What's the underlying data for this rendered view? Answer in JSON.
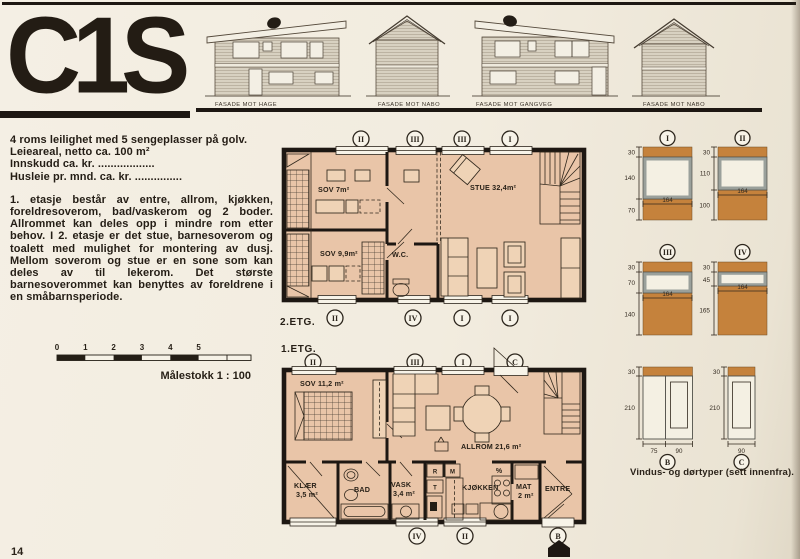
{
  "page": {
    "logo": "C1S",
    "page_number": "14"
  },
  "facades": {
    "labels": [
      "FASADE MOT HAGE",
      "FASADE MOT NABO",
      "FASADE MOT GANGVEG",
      "FASADE MOT NABO"
    ]
  },
  "intro": {
    "line1": "4 roms leilighet med 5 sengeplasser på golv.",
    "line2": "Leieareal, netto ca. 100 m²",
    "line3": "Innskudd ca. kr. ..................",
    "line4": "Husleie pr. mnd. ca. kr. ...............",
    "paragraph": "1. etasje består av entre, allrom, kjøkken, foreldresoverom, bad/vaskerom og 2 boder. Allrommet kan deles opp i mindre rom etter behov. I 2. etasje er det stue, barnesoverom og toalett med mulighet for montering av dusj. Mellom soverom og stue er en sone som kan deles av til lekerom. Det største barnesoverommet kan benyttes av foreldrene i en småbarnsperiode."
  },
  "scalebar": {
    "ticks": [
      "0",
      "1",
      "2",
      "3",
      "4",
      "5"
    ],
    "caption": "Målestokk 1 : 100"
  },
  "floor2": {
    "label": "2.ETG.",
    "markers_top": [
      "II",
      "III",
      "III",
      "I"
    ],
    "markers_bottom": [
      "II",
      "IV",
      "I",
      "I"
    ],
    "rooms": {
      "sov7": "SOV 7m²",
      "sov99": "SOV 9,9m²",
      "wc": "W.C.",
      "stue": "STUE 32,4m²"
    }
  },
  "floor1": {
    "label": "1.ETG.",
    "markers_top": [
      "II",
      "III",
      "I",
      "C"
    ],
    "markers_bottom": [
      "IV",
      "II",
      "B"
    ],
    "rooms": {
      "sov112": "SOV 11,2 m²",
      "allrom": "ALLROM 21,6 m²",
      "klaer1": "KLÆR",
      "klaer2": "3,5 m²",
      "bad": "BAD",
      "vask1": "VASK",
      "vask2": "3,4 m²",
      "kjokken": "KJØKKEN",
      "mat1": "MAT",
      "mat2": "2 m²",
      "entre": "ENTRE",
      "r": "R",
      "t": "T",
      "m": "M",
      "vent": "%"
    }
  },
  "openings": {
    "caption": "Vindus- og dørtyper (sett innenfra).",
    "win1": {
      "id": "I",
      "d_top": "30",
      "d_mid": "140",
      "d_bot": "70",
      "width": "164"
    },
    "win2": {
      "id": "II",
      "d_top": "30",
      "d_mid": "110",
      "d_bot": "100",
      "width": "164"
    },
    "win3": {
      "id": "III",
      "d_top": "30",
      "d_mid": "70",
      "d_bot": "140",
      "width": "164"
    },
    "win4": {
      "id": "IV",
      "d_top": "30",
      "d_mid": "45",
      "d_bot": "165",
      "width": "164"
    },
    "doorB": {
      "id": "B",
      "d_top": "30",
      "d_height": "210",
      "w1": "75",
      "w2": "90"
    },
    "doorC": {
      "id": "C",
      "d_top": "30",
      "d_height": "210",
      "w1": "90"
    }
  },
  "colors": {
    "paper": "#f2ecdf",
    "ink": "#1d1712",
    "plan_fill": "#e9c5a8",
    "wall_orange": "#c5823c"
  }
}
